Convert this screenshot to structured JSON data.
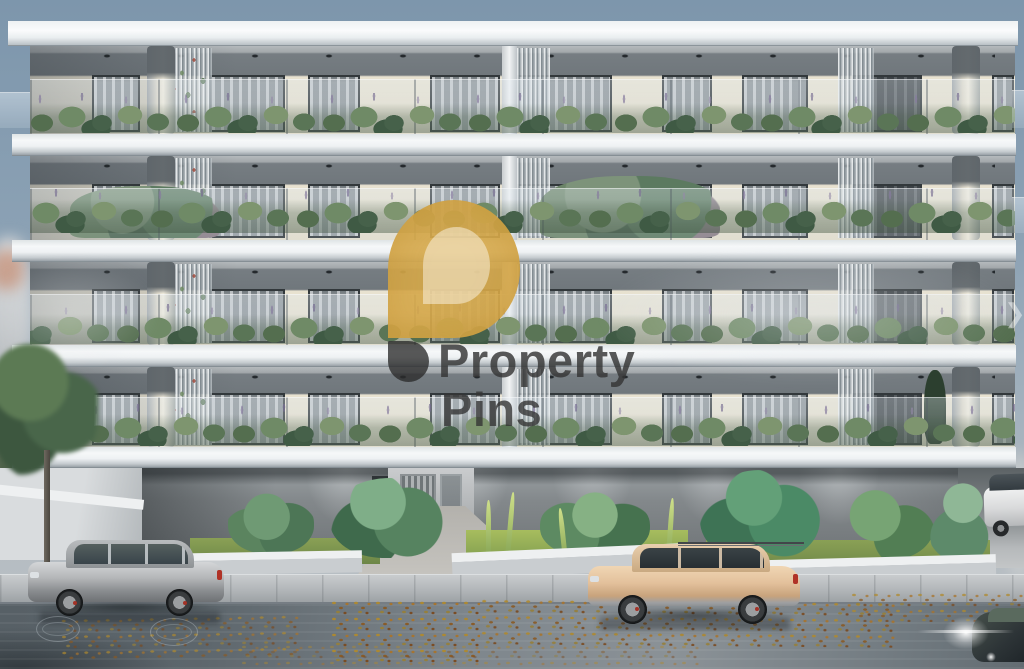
{
  "watermark": {
    "line1": "Property",
    "line2": "Pins",
    "pin_color": "#D6A84E",
    "text_color": "#343434"
  },
  "scene": {
    "balcony_floors": 4,
    "vehicles": [
      "silver-suv",
      "beige-suv",
      "white-suv",
      "dark-car-with-headlights"
    ]
  }
}
